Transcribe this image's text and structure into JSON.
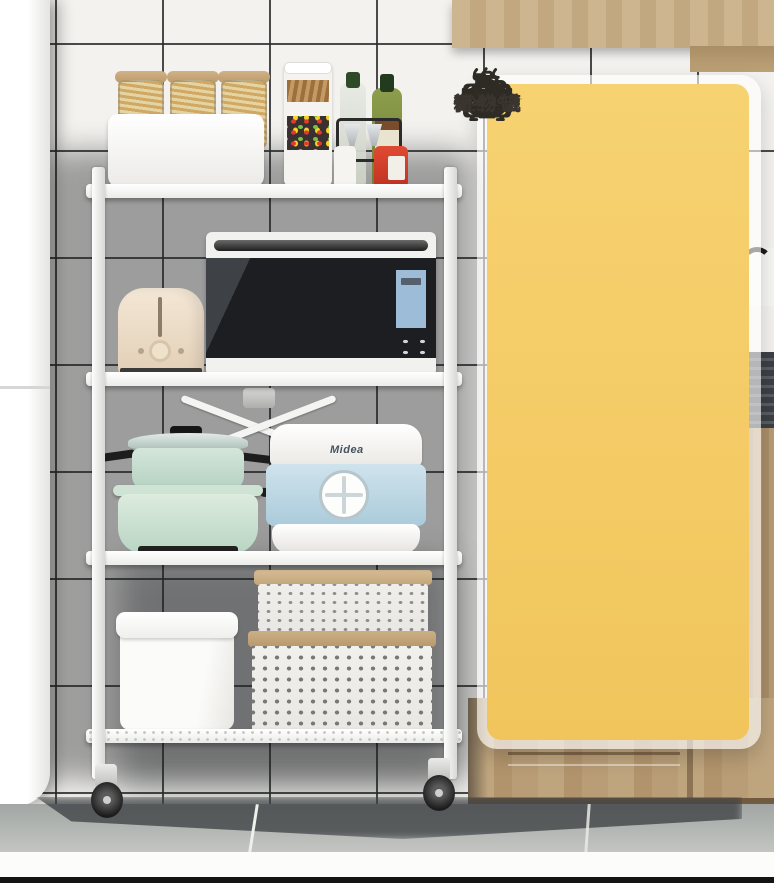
{
  "scene": {
    "cooker_brand": "Midea"
  },
  "panel": {
    "background_color": "#F5CD66",
    "icon_color": "#2E2A24",
    "label_color": "#3A352E",
    "divider_plus": "+",
    "items": [
      {
        "icon": "microwave-icon",
        "label": "微波炉"
      },
      {
        "icon": "oven-icon",
        "label": "烤箱"
      },
      {
        "icon": "rice-cooker-icon",
        "label": "电饭煲"
      },
      {
        "icon": "blender-icon",
        "label": "料理机"
      },
      {
        "icon": "pot-icon",
        "label": "锅具"
      },
      {
        "icon": "bowl-icon",
        "label": "碗碟"
      },
      {
        "icon": "seasoning-jar-icon",
        "label": "调料罐"
      },
      {
        "icon": "storage-box-icon",
        "label": "储物罐"
      }
    ]
  },
  "colors": {
    "bottom_bar": "#141414",
    "wood": "#C2A880",
    "tile_grout": "#2C2C2C"
  }
}
